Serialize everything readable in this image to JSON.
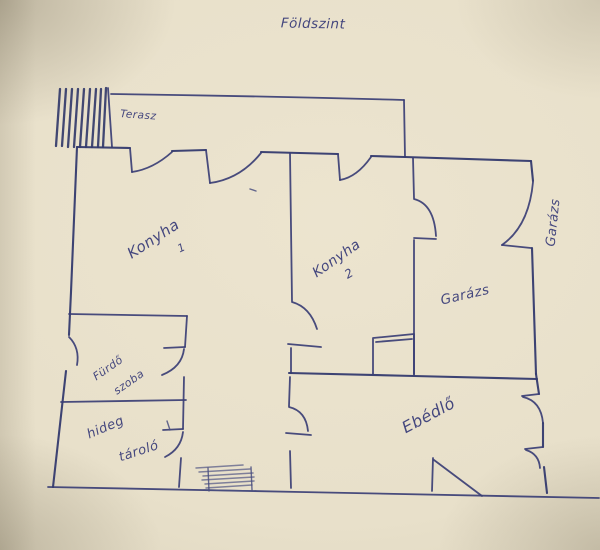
{
  "title": {
    "text": "Földszint"
  },
  "colors": {
    "paper": "#e8e0ca",
    "ink": "#3c3f7a"
  },
  "rooms": {
    "terasz": {
      "label": "Terasz"
    },
    "konyha1": {
      "label": "Konyha",
      "number": "1"
    },
    "konyha2": {
      "label": "Konyha",
      "number": "2"
    },
    "garazs": {
      "label": "Garázs"
    },
    "garazs_side_note": {
      "label": "Garázs"
    },
    "ebedlo": {
      "label": "Ebédlő"
    },
    "furdo_szoba": {
      "line1": "Fürdő",
      "line2": "szoba"
    },
    "hideg_tarolo": {
      "line1": "hideg",
      "line2": "tároló"
    }
  }
}
